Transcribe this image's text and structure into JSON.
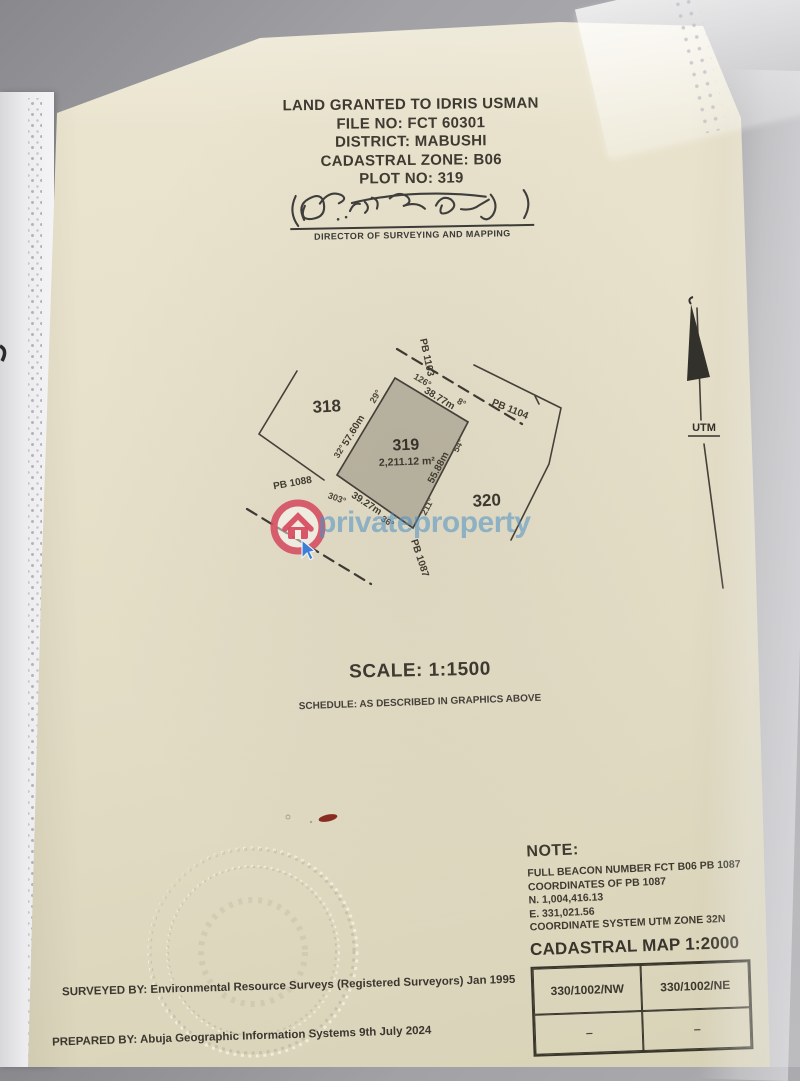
{
  "header": {
    "granted_to": "LAND GRANTED TO IDRIS USMAN",
    "file_no": "FILE NO: FCT 60301",
    "district": "DISTRICT: MABUSHI",
    "cadastral_zone": "CADASTRAL ZONE: B06",
    "plot_no": "PLOT NO: 319",
    "signatory_title": "DIRECTOR OF SURVEYING AND MAPPING"
  },
  "plan": {
    "plot_label": "319",
    "area_label": "2,211.12 m²",
    "plot_left": "318",
    "plot_right": "320",
    "beacon_top": "PB 1103",
    "beacon_right": "PB 1104",
    "beacon_left": "PB 1088",
    "beacon_bottom": "PB 1087",
    "edge_top_bearing": "126°",
    "edge_top_distance": "38.77m",
    "edge_top_adjacent_bearing": "8°",
    "edge_left_bearing_upper": "29°",
    "edge_left_bearing_lower": "32°",
    "edge_left_distance": "57.60m",
    "edge_bottom_bearing": "303°",
    "edge_bottom_distance": "39.27m",
    "edge_bottom_corner_bearing": "36°",
    "edge_right_bearing_upper": "54°",
    "edge_right_bearing_lower": "211°",
    "edge_right_distance": "55.88m",
    "north_arrow_label": "UTM"
  },
  "scale": {
    "scale_text": "SCALE: 1:1500",
    "schedule_text": "SCHEDULE: AS DESCRIBED IN GRAPHICS ABOVE"
  },
  "note": {
    "heading": "NOTE:",
    "lines": [
      "FULL BEACON NUMBER FCT B06 PB 1087",
      "COORDINATES OF PB 1087",
      "N. 1,004,416.13",
      "E. 331,021.56",
      "COORDINATE SYSTEM UTM ZONE 32N"
    ]
  },
  "cadastral_map": {
    "title": "CADASTRAL MAP 1:2000",
    "row1": [
      "330/1002/NW",
      "330/1002/NE"
    ],
    "row2": [
      "---",
      "---"
    ]
  },
  "footer": {
    "surveyed_by": "SURVEYED BY: Environmental Resource Surveys (Registered Surveyors)  Jan 1995",
    "prepared_by": "PREPARED BY: Abuja Geographic Information Systems  9th July 2024"
  },
  "watermark": {
    "brand": "privateproperty",
    "brand_color": "#4d8fc4",
    "logo_color": "#d5485c"
  }
}
